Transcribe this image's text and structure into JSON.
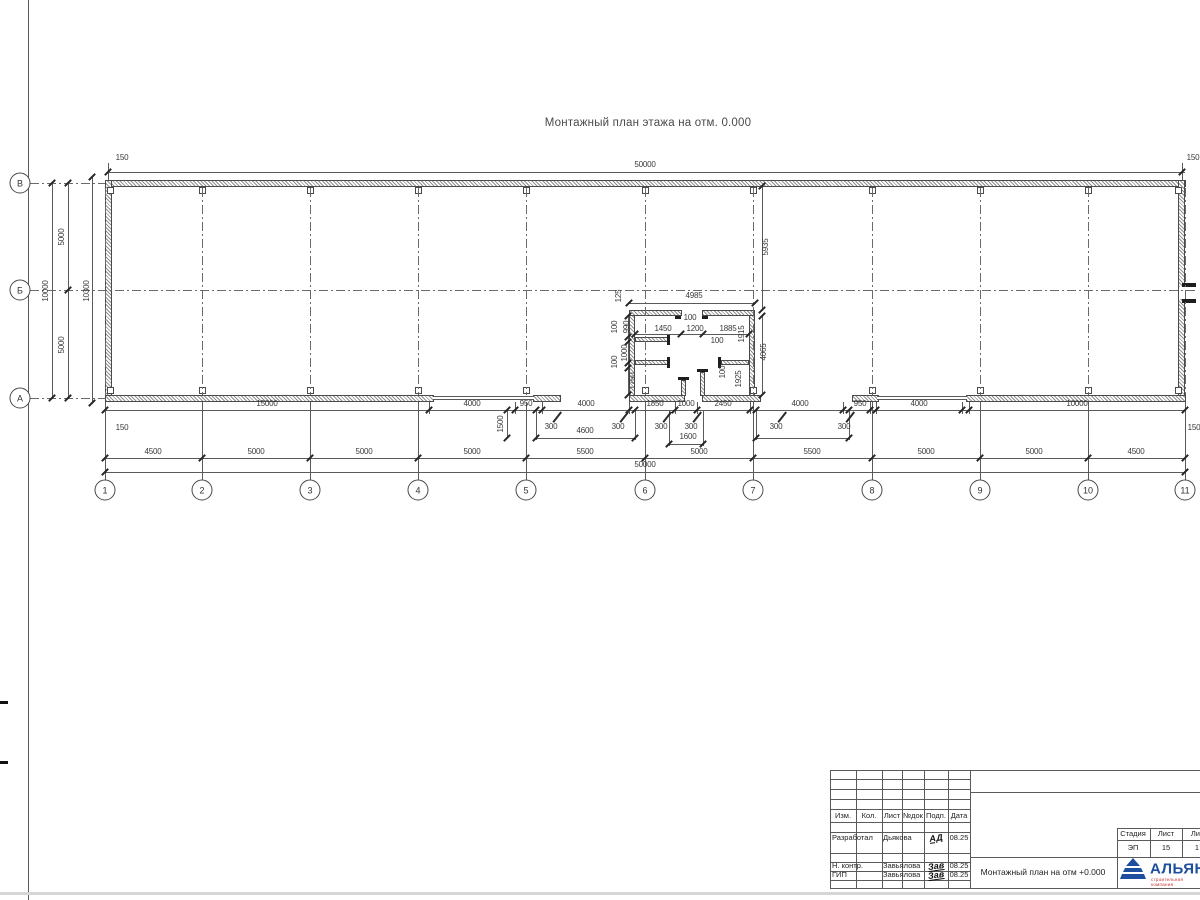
{
  "sheet": {
    "title": "Монтажный план этажа на отм. 0.000"
  },
  "axes": {
    "bottom": [
      "1",
      "2",
      "3",
      "4",
      "5",
      "6",
      "7",
      "8",
      "9",
      "10",
      "11"
    ],
    "left": [
      "В",
      "Б",
      "А"
    ]
  },
  "labels": [
    {
      "t": "50000",
      "x": 645,
      "y": 165
    },
    {
      "t": "150",
      "x": 122,
      "y": 158
    },
    {
      "t": "150",
      "x": 1193,
      "y": 158
    },
    {
      "t": "150",
      "x": 122,
      "y": 428
    },
    {
      "t": "150",
      "x": 1194,
      "y": 428
    },
    {
      "t": "10000",
      "x": 46,
      "y": 291,
      "r": 1
    },
    {
      "t": "5000",
      "x": 62,
      "y": 237,
      "r": 1
    },
    {
      "t": "5000",
      "x": 62,
      "y": 345,
      "r": 1
    },
    {
      "t": "10300",
      "x": 87,
      "y": 291,
      "r": 1
    },
    {
      "t": "15000",
      "x": 267,
      "y": 404
    },
    {
      "t": "4000",
      "x": 472,
      "y": 404
    },
    {
      "t": "950",
      "x": 526,
      "y": 404
    },
    {
      "t": "4000",
      "x": 586,
      "y": 404
    },
    {
      "t": "1850",
      "x": 655,
      "y": 404
    },
    {
      "t": "1000",
      "x": 686,
      "y": 404
    },
    {
      "t": "2450",
      "x": 723,
      "y": 404
    },
    {
      "t": "4000",
      "x": 800,
      "y": 404
    },
    {
      "t": "950",
      "x": 860,
      "y": 404
    },
    {
      "t": "4000",
      "x": 919,
      "y": 404
    },
    {
      "t": "10000",
      "x": 1077,
      "y": 404
    },
    {
      "t": "300",
      "x": 551,
      "y": 427
    },
    {
      "t": "300",
      "x": 618,
      "y": 427
    },
    {
      "t": "300",
      "x": 661,
      "y": 427
    },
    {
      "t": "300",
      "x": 691,
      "y": 427
    },
    {
      "t": "300",
      "x": 776,
      "y": 427
    },
    {
      "t": "300",
      "x": 844,
      "y": 427
    },
    {
      "t": "4600",
      "x": 585,
      "y": 431
    },
    {
      "t": "1600",
      "x": 688,
      "y": 437
    },
    {
      "t": "1500",
      "x": 501,
      "y": 424,
      "r": 1
    },
    {
      "t": "4500",
      "x": 153,
      "y": 452
    },
    {
      "t": "5000",
      "x": 256,
      "y": 452
    },
    {
      "t": "5000",
      "x": 364,
      "y": 452
    },
    {
      "t": "5000",
      "x": 472,
      "y": 452
    },
    {
      "t": "5500",
      "x": 585,
      "y": 452
    },
    {
      "t": "5000",
      "x": 699,
      "y": 452
    },
    {
      "t": "5500",
      "x": 812,
      "y": 452
    },
    {
      "t": "5000",
      "x": 926,
      "y": 452
    },
    {
      "t": "5000",
      "x": 1034,
      "y": 452
    },
    {
      "t": "4500",
      "x": 1136,
      "y": 452
    },
    {
      "t": "50000",
      "x": 645,
      "y": 465
    },
    {
      "t": "5935",
      "x": 766,
      "y": 247,
      "r": 1
    },
    {
      "t": "4065",
      "x": 764,
      "y": 352,
      "r": 1
    },
    {
      "t": "4985",
      "x": 694,
      "y": 296
    },
    {
      "t": "125",
      "x": 619,
      "y": 296,
      "r": 1
    },
    {
      "t": "100",
      "x": 690,
      "y": 318
    },
    {
      "t": "1450",
      "x": 663,
      "y": 329
    },
    {
      "t": "1200",
      "x": 695,
      "y": 329
    },
    {
      "t": "1885",
      "x": 728,
      "y": 329
    },
    {
      "t": "100",
      "x": 717,
      "y": 341
    },
    {
      "t": "990",
      "x": 627,
      "y": 327,
      "r": 1
    },
    {
      "t": "100",
      "x": 615,
      "y": 327,
      "r": 1
    },
    {
      "t": "1000",
      "x": 625,
      "y": 353,
      "r": 1
    },
    {
      "t": "100",
      "x": 615,
      "y": 362,
      "r": 1
    },
    {
      "t": "1750",
      "x": 633,
      "y": 381,
      "r": 1
    },
    {
      "t": "1915",
      "x": 742,
      "y": 334,
      "r": 1
    },
    {
      "t": "1925",
      "x": 739,
      "y": 379,
      "r": 1
    },
    {
      "t": "100",
      "x": 723,
      "y": 372,
      "r": 1
    }
  ],
  "title_block": {
    "header_cols": [
      "Изм.",
      "Кол.",
      "Лист",
      "№док",
      "Подп.",
      "Дата"
    ],
    "rows": [
      {
        "role": "Разработал",
        "name": "Дьякова",
        "sign": "АД",
        "date": "08.25"
      },
      {
        "role": "Н. контр.",
        "name": "Завьялова",
        "sign": "Зав",
        "date": "08.25"
      },
      {
        "role": "ГИП",
        "name": "Завьялова",
        "sign": "Зав",
        "date": "08.25"
      }
    ],
    "doc_title": "Монтажный план на отм +0.000",
    "stage_label": "Стадия",
    "sheet_label": "Лист",
    "sheets_label": "Листов",
    "stage": "ЭП",
    "sheet": "15",
    "sheets": "1",
    "logo_text": "АЛЬЯНС",
    "logo_sub": "строительная компания",
    "logo_color": "#1d4f9e",
    "logo_sub_color": "#c43030"
  }
}
